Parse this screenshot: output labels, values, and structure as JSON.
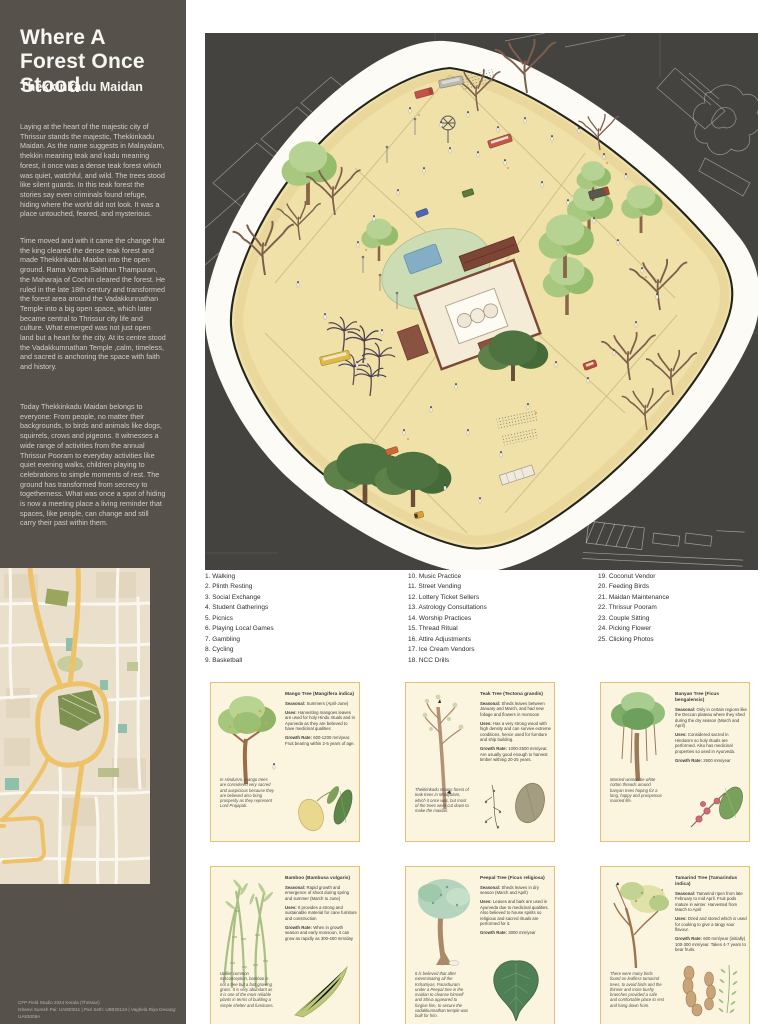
{
  "sidebar": {
    "title": "Where A Forest Once Stood",
    "subtitle": "Thekkinkadu Maidan",
    "paragraphs": [
      "Laying at the heart of the majestic city of Thrissur stands the majestic, Thekkinkadu Maidan. As the name suggests in Malayalam, thekkin meaning teak and kadu meaning forest, it once was a dense teak forest which was quiet, watchful, and wild. The trees stood like silent guards. In this teak forest the stories say even criminals found refuge, hiding where the world did not look. It was a place untouched, feared, and mysterious.",
      "Time moved and with it came the change that the king cleared the dense teak forest and made Thekkinkadu Maidan into the open ground. Rama Varma Sakthan Thampuran, the Maharaja of Cochin cleared the forest.  He ruled in the late 18th century and transformed the forest area around the Vadakkunnathan Temple into a big open space, which later became central to Thrissur city life and culture. What emerged was not just open land but a heart for the city. At its centre stood the Vadakkumnathan Temple ,calm, timeless, and sacred is anchoring the space with faith and history.",
      "Today Thekkinkadu Maidan belongs to everyone: From people, no matter their backgrounds, to birds and  animals like dogs, squirrels, crows and pigeons. It witnesses a wide range of activities from the annual Thrissur Pooram to everyday activities like quiet evening walks, children playing to celebrations to simple moments of rest. The ground has transformed from secrecy to togetherness. What was once a spot of hiding is now a meeting place a living reminder that spaces, like people, can change and still carry their past within them."
    ],
    "footer": [
      "CFP Field Studio 2024 Kerala (Thrissur)",
      "Ishanvi Suresh Pai: UA830011  |  Pari Seth: UB020134  |  Vaghela Riya Devang: UA83008A"
    ]
  },
  "legend": {
    "columns": [
      [
        "1. Walking",
        "2. Plinth Resting",
        "3. Social Exchange",
        "4. Student Gatherings",
        "5. Picnics",
        "6. Playing Local Games",
        "7. Gambling",
        "8. Cycling",
        "9. Basketball"
      ],
      [
        "10. Music Practice",
        "11. Street Vending",
        "12. Lottery Ticket Sellers",
        "13. Astrology Consultations",
        "14. Worship Practices",
        "15. Thread Ritual",
        "16. Attire Adjustments",
        "17. Ice Cream Vendors",
        "18. NCC Drills"
      ],
      [
        "19. Coconut Vendor",
        "20. Feeding Birds",
        "21. Maidan Maintenance",
        "22. Thrissur Pooram",
        "23. Couple Sitting",
        "24. Picking Flower",
        "25. Clicking Photos"
      ]
    ]
  },
  "card_labels": {
    "seasonal": "Seasonal:",
    "uses": "Uses:",
    "growth": "Growth Rate:"
  },
  "cards": [
    {
      "illustration": "mango-tree",
      "title": "Mango Tree (Mangifera indica)",
      "seasonal": "Summers (April-June)",
      "uses": "Harvesting mangoes leaves are used for holy Hindu rituals and in Ayurveda as they are believed to have medicinal qualities",
      "growth": "600-1200 mm/year. Fruit bearing within 2-5 years of age.",
      "note": "In Hinduism, mango trees are considered very sacred and auspicious because they are believed also bring prosperity as they represent Lord Prajapati."
    },
    {
      "illustration": "teak-tree",
      "title": "Teak Tree (Tectona grandis)",
      "seasonal": "Sheds leaves between January and March, and had new foliage and flowers in monsoon",
      "uses": "Has a very strong wood with high density and can survive extreme conditions, hence used for furniture and ship building.",
      "growth": "1000-2500 mm/year. Are usually good enough to harvest timber withing 20-25 years.",
      "note": "Thekkinkadu means forest of teak trees in Malayalam, which it once was, but most of the trees were cut down to make the maidan."
    },
    {
      "illustration": "banyan-tree",
      "title": "Banyan Tree (Ficus bengalensis)",
      "seasonal": "Only in certain regions like the Deccan plateau where they shed during the dry season (March and April)",
      "uses": "Considered sacred in Hinduism so holy rituals are performed. Also has medicinal properties so used in Ayurveda.",
      "growth": "2600 mm/year",
      "note": "Married women tie white cotton threads around banyan trees hoping for a long, happy and prosperous married life."
    },
    {
      "illustration": "bamboo",
      "title": "Bamboo (Bambusa vulgaris)",
      "seasonal": "Rapid growth and emergence of shoot during spring and summer (March to June)",
      "uses": "It provides a strong and sustainable material for cane furniture and construction",
      "growth": "When in growth season and early monsoon, it can grow as rapidly as 300-400 mm/day",
      "note": "Unlike common misconception, bamboo is not a tree but a fast growing grass. It is very abundant as it is one of the most reliable plants in terms of building a simple shelter and furnitures."
    },
    {
      "illustration": "peepal-tree",
      "title": "Peepal Tree (Ficus religiosa)",
      "seasonal": "Sheds leaves in dry season (March and April)",
      "uses": "Leaves and bark are used in Ayurveda due to medicinal qualities. Also believed to house spirits so religious and sacred rituals are performed for it.",
      "growth": "3000 mm/year",
      "note": "It is believed that after exterminating all the Kshatriyas, Parashuram under a Peepal tree in the maidan to cleanse himself and Shiva appeared to forgive him, to secure the vadakkunnathan temple was built for him."
    },
    {
      "illustration": "tamarind-tree",
      "title": "Tamarind Tree (Tamarindus indica)",
      "seasonal": "Tamarind ripen from late February to mid April. Fruit pods mature in winter. Harvested from March to April",
      "uses": "Dried and stored which is used for cooking to give a tangy sour flavour.",
      "growth": "600 mm/year (initially) 100-300 mm/year. Takes 4-7 years to bear fruits.",
      "note": "There were many birds found on leafless tamarind trees, to avoid birds and the thinner and more bushy branches provided a safe and comfortable place to rest and hang down from."
    }
  ],
  "colors": {
    "sidebar_bg": "#56524b",
    "illustration_bg": "#454340",
    "park_ground": "#f0e1a8",
    "card_bg": "#fbf5df",
    "card_border": "#e0c177",
    "road_yellow": "#eec268"
  }
}
